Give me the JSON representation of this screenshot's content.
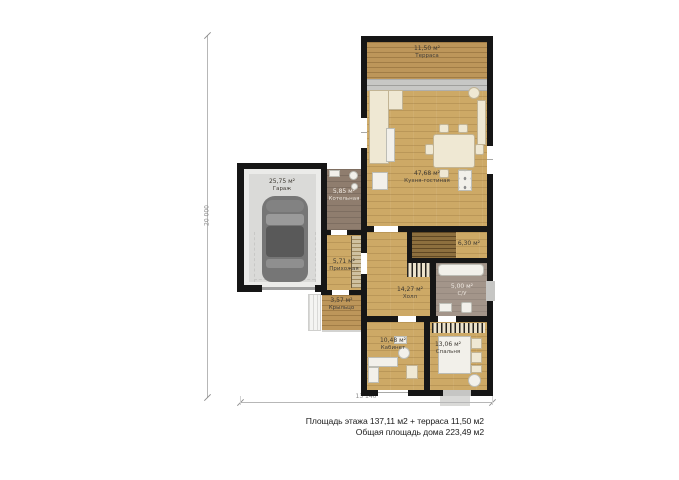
{
  "plan": {
    "rooms": {
      "terrace": {
        "area": "11,50 м²",
        "name": "Терраса"
      },
      "kitchen": {
        "area": "47,68 м²",
        "name": "Кухня-гостиная"
      },
      "garage": {
        "area": "25,75 м²",
        "name": "Гараж"
      },
      "boiler": {
        "area": "5,85 м²",
        "name": "Котельная"
      },
      "entry": {
        "area": "5,71 м²",
        "name": "Прихожая"
      },
      "porch": {
        "area": "3,57 м²",
        "name": "Крыльцо"
      },
      "hall": {
        "area": "14,27 м²",
        "name": "Холл"
      },
      "stairs": {
        "area": "6,30 м²",
        "name": ""
      },
      "wc": {
        "area": "5,00 м²",
        "name": "С/У"
      },
      "office": {
        "area": "10,48 м²",
        "name": "Кабинет"
      },
      "bedroom": {
        "area": "13,06 м²",
        "name": "Спальня"
      }
    },
    "dimensions": {
      "height": "20 000",
      "width": "13 140"
    },
    "summary": {
      "line1": "Площадь этажа 137,11 м2 + терраса 11,50 м2",
      "line2": "Общая площадь дома 223,49 м2"
    }
  }
}
